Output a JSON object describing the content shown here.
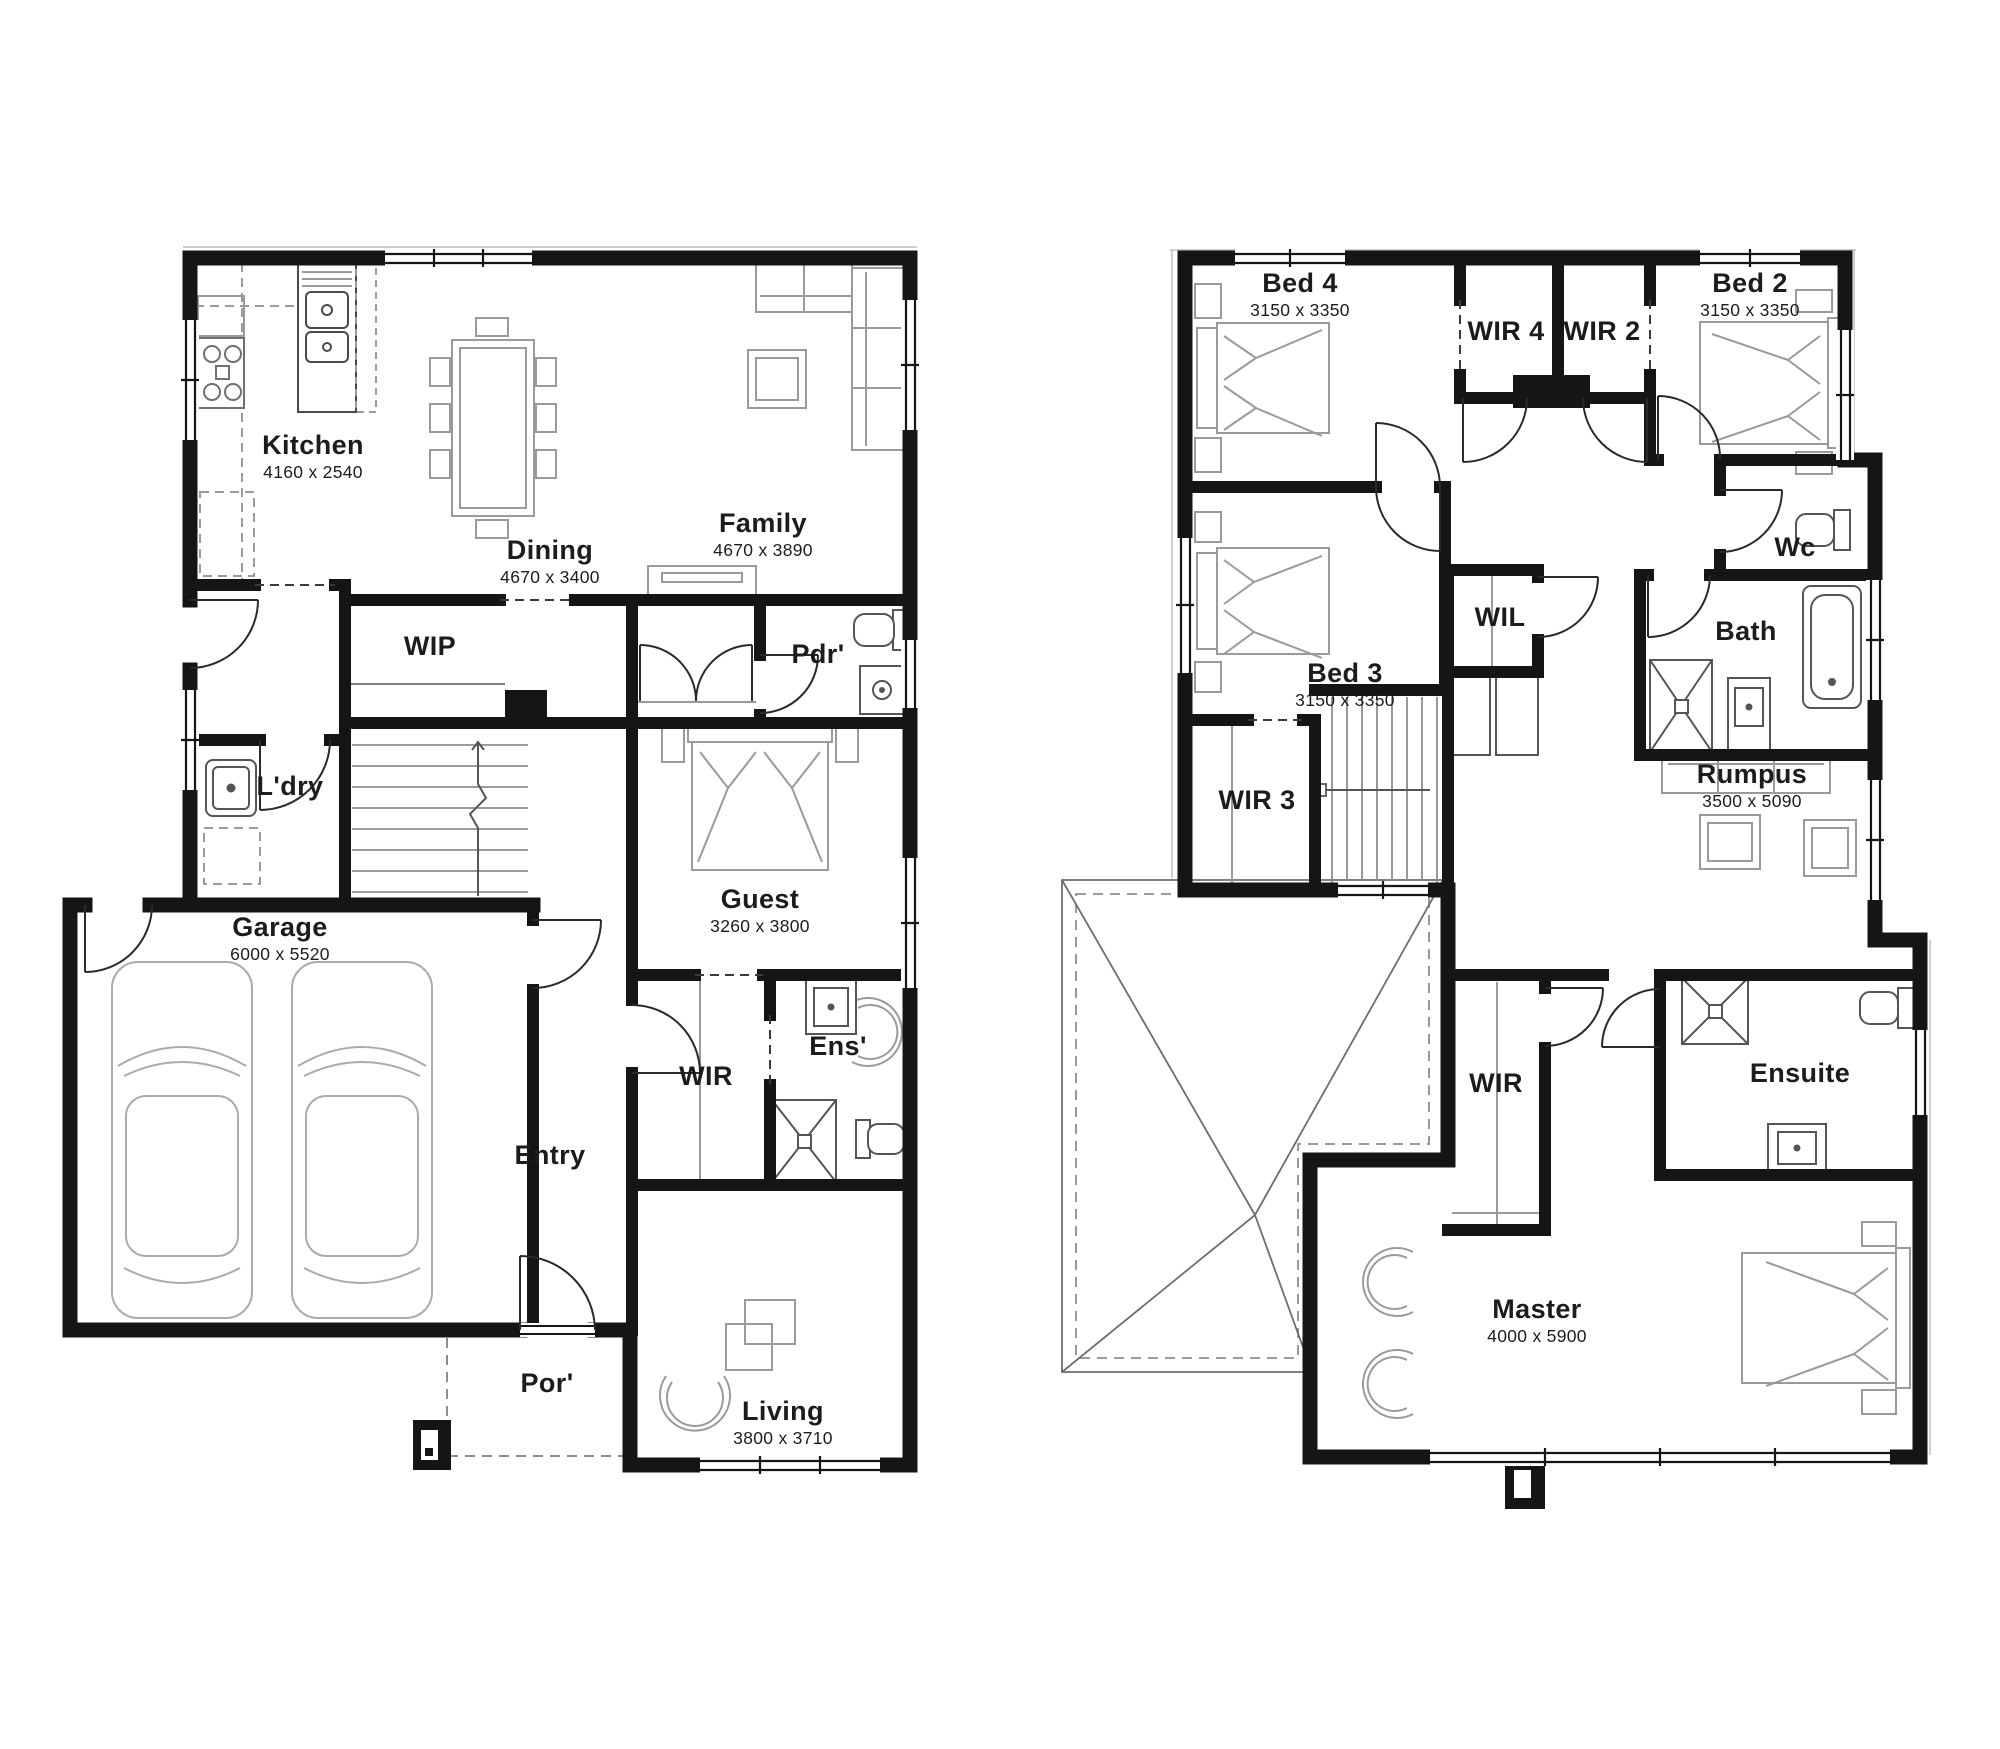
{
  "ground_floor": {
    "rooms": [
      {
        "label": "Kitchen",
        "dims": "4160 x 2540"
      },
      {
        "label": "Dining",
        "dims": "4670 x 3400"
      },
      {
        "label": "Family",
        "dims": "4670 x 3890"
      },
      {
        "label": "WIP",
        "dims": ""
      },
      {
        "label": "Pdr'",
        "dims": ""
      },
      {
        "label": "L'dry",
        "dims": ""
      },
      {
        "label": "Garage",
        "dims": "6000 x 5520"
      },
      {
        "label": "Guest",
        "dims": "3260 x 3800"
      },
      {
        "label": "Entry",
        "dims": ""
      },
      {
        "label": "WIR",
        "dims": ""
      },
      {
        "label": "Ens'",
        "dims": ""
      },
      {
        "label": "Por'",
        "dims": ""
      },
      {
        "label": "Living",
        "dims": "3800 x 3710"
      }
    ]
  },
  "upper_floor": {
    "rooms": [
      {
        "label": "Bed 4",
        "dims": "3150 x 3350"
      },
      {
        "label": "WIR 4",
        "dims": ""
      },
      {
        "label": "WIR 2",
        "dims": ""
      },
      {
        "label": "Bed 2",
        "dims": "3150 x 3350"
      },
      {
        "label": "Wc",
        "dims": ""
      },
      {
        "label": "Bed 3",
        "dims": "3150 x 3350"
      },
      {
        "label": "WIL",
        "dims": ""
      },
      {
        "label": "Bath",
        "dims": ""
      },
      {
        "label": "Rumpus",
        "dims": "3500 x 5090"
      },
      {
        "label": "WIR 3",
        "dims": ""
      },
      {
        "label": "WIR",
        "dims": ""
      },
      {
        "label": "Ensuite",
        "dims": ""
      },
      {
        "label": "Master",
        "dims": "4000 x 5900"
      }
    ]
  },
  "colors": {
    "wall": "#151515",
    "furniture": "#9a9a9a",
    "text": "#1c1c1c",
    "background": "#ffffff"
  }
}
